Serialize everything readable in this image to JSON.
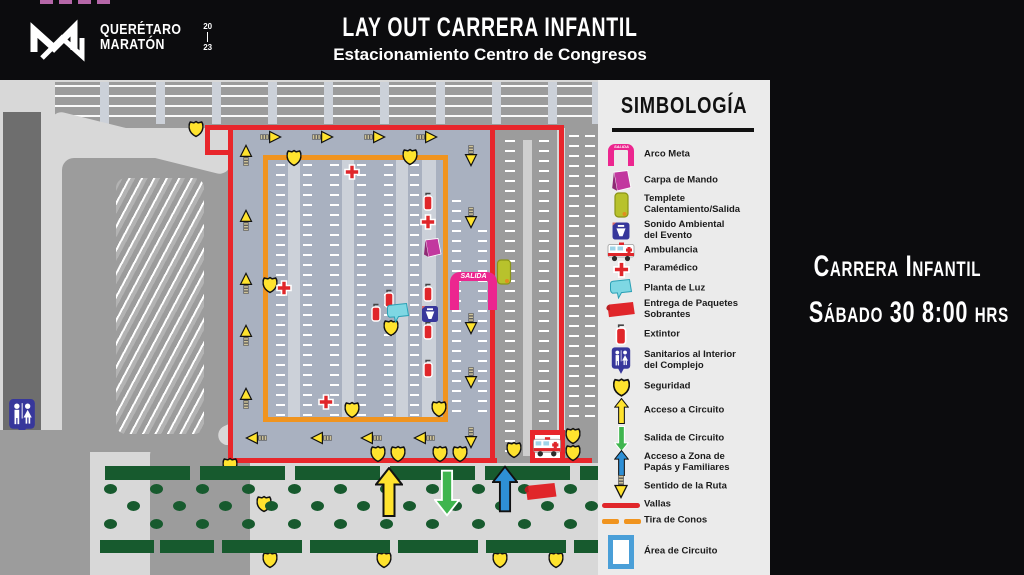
{
  "header": {
    "logo_top": "QUERÉTARO",
    "logo_bottom": "MARATÓN",
    "year_top": "20",
    "year_bottom": "23",
    "title": "LAY OUT CARRERA INFANTIL",
    "subtitle": "Estacionamiento Centro de Congresos"
  },
  "side_panel": {
    "line1": "Carrera Infantil",
    "line2": "Sábado 30 8:00 hrs"
  },
  "map": {
    "salida_label": "SALIDA"
  },
  "legend": {
    "title": "SIMBOLOGÍA",
    "items": [
      {
        "icon": "arco-meta-icon",
        "label": "Arco Meta"
      },
      {
        "icon": "carpa-de-mando-icon",
        "label": "Carpa de Mando"
      },
      {
        "icon": "templete-icon",
        "label": "Templete\nCalentamiento/Salida"
      },
      {
        "icon": "sonido-ambiental-icon",
        "label": "Sonido Ambiental\ndel Evento"
      },
      {
        "icon": "ambulancia-icon",
        "label": "Ambulancia"
      },
      {
        "icon": "paramedico-icon",
        "label": "Paramédico"
      },
      {
        "icon": "planta-de-luz-icon",
        "label": "Planta de Luz"
      },
      {
        "icon": "entrega-paquetes-icon",
        "label": "Entrega de Paquetes\nSobrantes"
      },
      {
        "icon": "extintor-icon",
        "label": "Extintor"
      },
      {
        "icon": "sanitarios-icon",
        "label": "Sanitarios al Interior\ndel Complejo"
      },
      {
        "icon": "seguridad-icon",
        "label": "Seguridad"
      },
      {
        "icon": "acceso-circuito-icon",
        "label": "Acceso a Circuito"
      },
      {
        "icon": "salida-circuito-icon",
        "label": "Salida de Circuito"
      },
      {
        "icon": "acceso-zona-icon",
        "label": "Acceso a Zona de\nPapás y Familiares"
      },
      {
        "icon": "sentido-ruta-icon",
        "label": "Sentido de la Ruta"
      },
      {
        "icon": "vallas-icon",
        "label": "Vallas"
      },
      {
        "icon": "tira-de-conos-icon",
        "label": "Tira de Conos"
      },
      {
        "icon": "area-circuito-icon",
        "label": "Área de Circuito"
      }
    ]
  },
  "colors": {
    "vallas_red": "#e8262b",
    "cones_orange": "#f0941f",
    "circuit_area_blue": "#a9b1c0",
    "arch_pink": "#ec268f",
    "security_yellow": "#ffe32e",
    "exit_green": "#3fb54e",
    "family_blue": "#2e8fd5",
    "planter_green": "#175a2e"
  }
}
